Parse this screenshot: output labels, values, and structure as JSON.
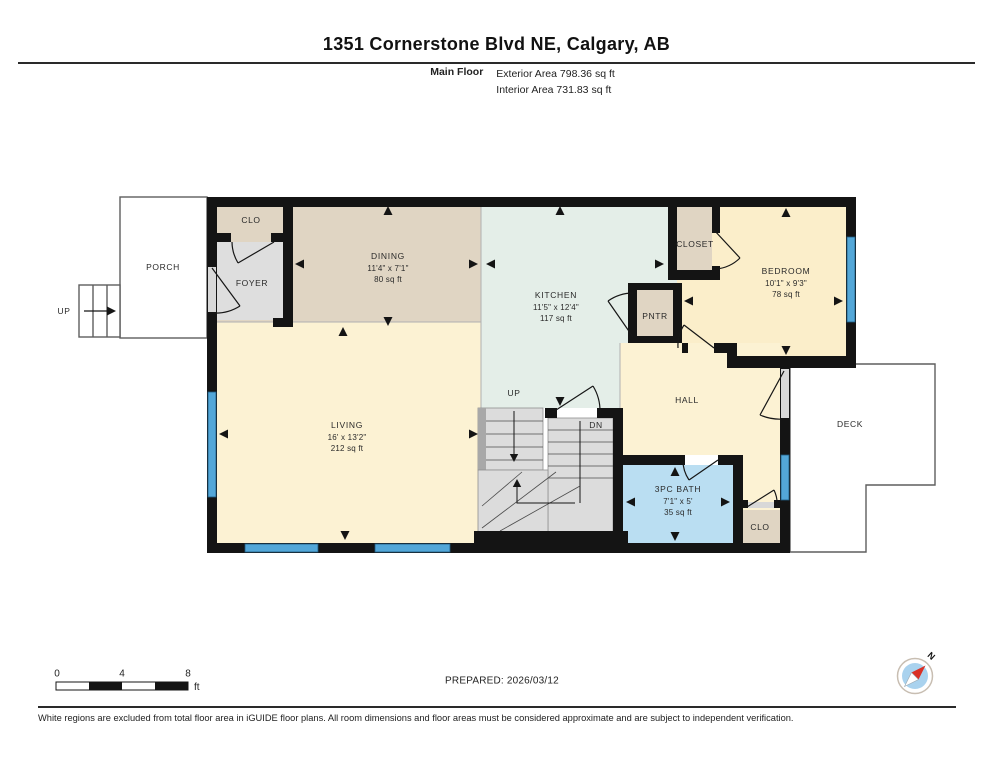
{
  "header": {
    "title": "1351 Cornerstone Blvd NE, Calgary, AB",
    "floor_label": "Main Floor",
    "exterior_area": "Exterior Area 798.36 sq ft",
    "interior_area": "Interior Area 731.83 sq ft"
  },
  "rooms": {
    "dining": {
      "name": "DINING",
      "dims": "11'4\" x 7'1\"",
      "area": "80 sq ft"
    },
    "kitchen": {
      "name": "KITCHEN",
      "dims": "11'5\" x 12'4\"",
      "area": "117 sq ft"
    },
    "bedroom": {
      "name": "BEDROOM",
      "dims": "10'1\" x 9'3\"",
      "area": "78 sq ft"
    },
    "living": {
      "name": "LIVING",
      "dims": "16' x 13'2\"",
      "area": "212 sq ft"
    },
    "bath": {
      "name": "3PC BATH",
      "dims": "7'1\" x 5'",
      "area": "35 sq ft"
    },
    "hall": {
      "name": "HALL"
    },
    "deck": {
      "name": "DECK"
    },
    "porch": {
      "name": "PORCH"
    },
    "foyer": {
      "name": "FOYER"
    },
    "closet": {
      "name": "CLOSET"
    },
    "pantry": {
      "name": "PNTR"
    },
    "clo_top": {
      "name": "CLO"
    },
    "clo_bottom": {
      "name": "CLO"
    }
  },
  "stairs": {
    "up_label": "UP",
    "dn_label": "DN",
    "porch_up_label": "UP"
  },
  "scale_bar": {
    "t0": "0",
    "t4": "4",
    "t8": "8",
    "unit": "ft"
  },
  "prepared": "PREPARED: 2026/03/12",
  "compass": {
    "north_label": "N"
  },
  "footer": "White regions are excluded from total floor area in iGUIDE floor plans. All room dimensions and floor areas must be considered approximate and are subject to independent verification.",
  "colors": {
    "wall": "#141414",
    "window_blue": "#53a7d8",
    "bath_blue": "#badef2",
    "tan": "#e0d5c3",
    "cream": "#fcf2d3",
    "bedroom_cream": "#fbeeca",
    "kitchen_mint": "#e4eee8",
    "foyer_gray": "#dedede",
    "stair_gray": "#dcdcdc",
    "compass_red": "#d93025"
  }
}
